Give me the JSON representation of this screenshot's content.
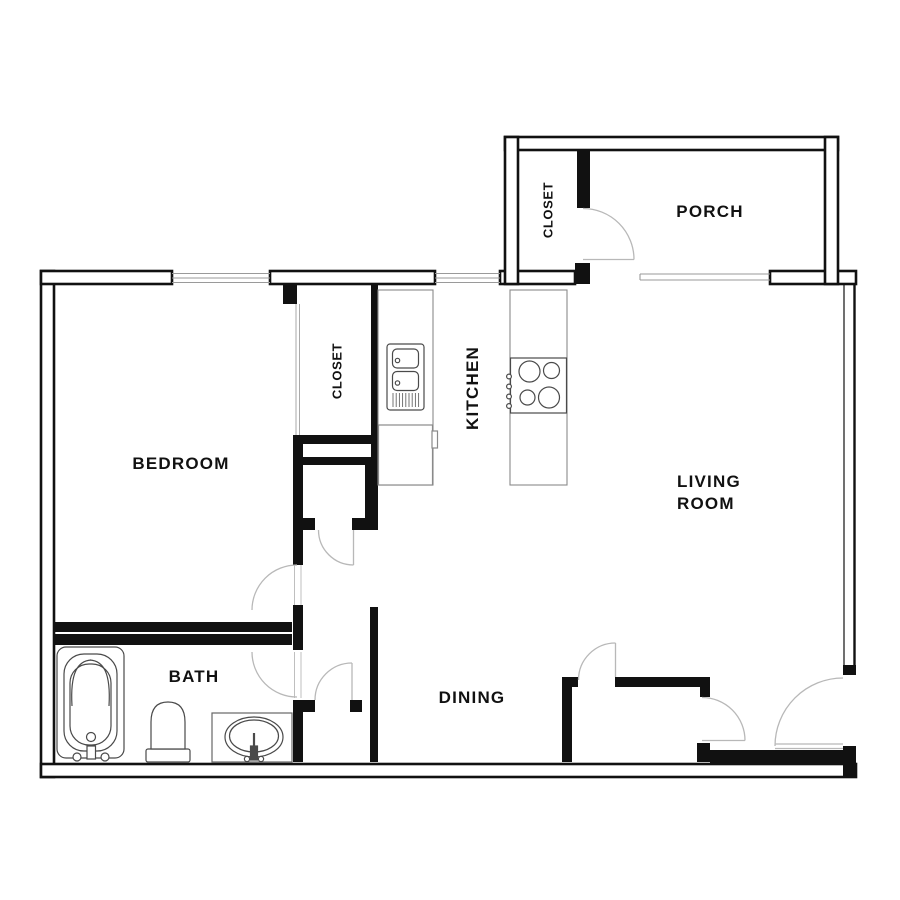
{
  "floor_plan": {
    "rooms": {
      "bedroom": {
        "label": "BEDROOM"
      },
      "bedroom_closet": {
        "label": "CLOSET"
      },
      "kitchen": {
        "label": "KITCHEN"
      },
      "living_room": {
        "line1": "LIVING",
        "line2": "ROOM"
      },
      "porch": {
        "label": "PORCH"
      },
      "porch_closet": {
        "label": "CLOSET"
      },
      "bath": {
        "label": "BATH"
      },
      "dining": {
        "label": "DINING"
      }
    },
    "fixtures": [
      "bathtub",
      "toilet",
      "vanity-sink",
      "kitchen-sink-double",
      "refrigerator",
      "cooktop-4-burner"
    ],
    "colors": {
      "wall": "#111111",
      "door": "#b8b8b8",
      "window": "#9a9a9a",
      "fixture": "#4a4a4a",
      "counter": "#8a8a8a",
      "text": "#111111",
      "bg": "#ffffff"
    }
  }
}
